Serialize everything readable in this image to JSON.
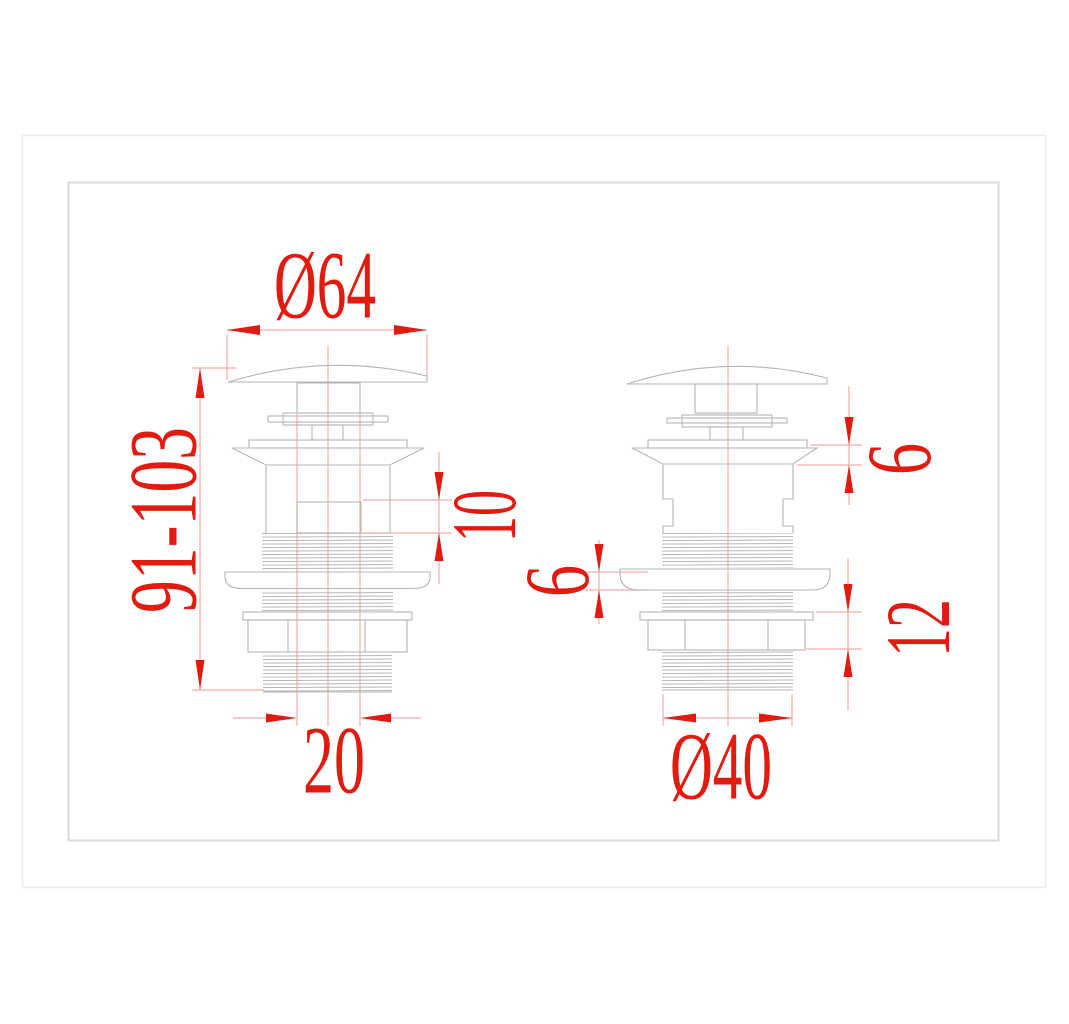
{
  "colors": {
    "dimension_red": "#e21b10",
    "extension_pink": "#f5aca6",
    "line_gray": "#b5b5b5",
    "frame_outer": "#ececec",
    "frame_inner": "#d9d9d9",
    "background": "#ffffff"
  },
  "views": {
    "left_view": {
      "cap_diameter": "Ø64",
      "overall_height": "91-103",
      "overflow_slot_height": "10",
      "outlet_stem_width": "20"
    },
    "middle": {
      "washer_thickness": "6"
    },
    "right_view": {
      "top_flange_height": "6",
      "locknut_height": "12",
      "outlet_thread_diameter": "Ø40"
    }
  }
}
